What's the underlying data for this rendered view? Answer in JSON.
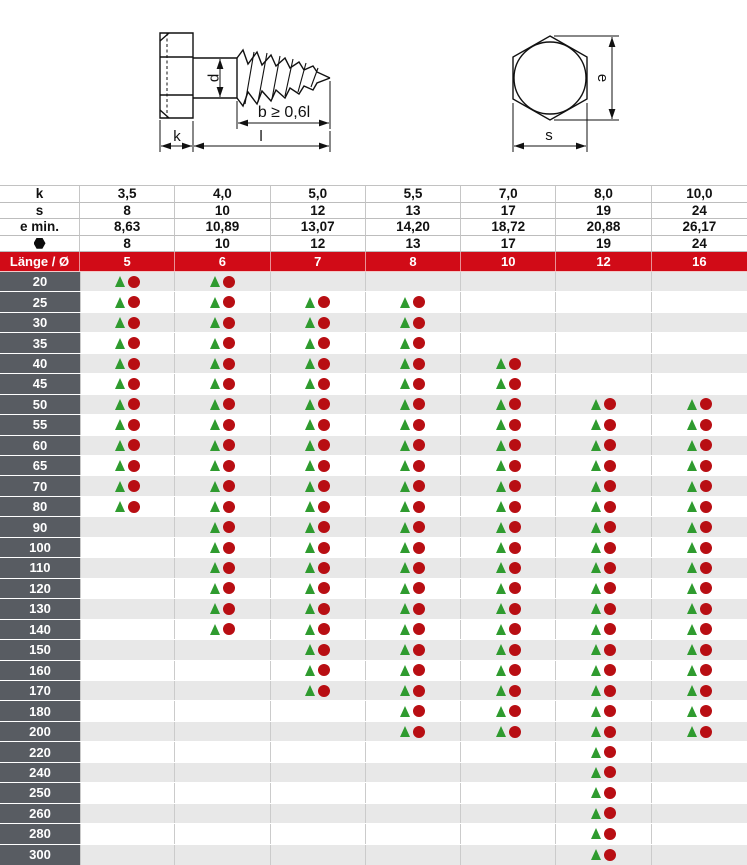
{
  "drawing": {
    "shank_diameter_label": "d",
    "thread_length_label": "b ≥ 0,6l",
    "head_height_label": "k",
    "total_length_label": "l",
    "across_corners_label": "e",
    "across_flats_label": "s"
  },
  "spec_header": {
    "rows": [
      {
        "name": "head-height",
        "label": "k",
        "icon": null,
        "values": [
          "3,5",
          "4,0",
          "5,0",
          "5,5",
          "7,0",
          "8,0",
          "10,0"
        ]
      },
      {
        "name": "across-flats",
        "label": "s",
        "icon": null,
        "values": [
          "8",
          "10",
          "12",
          "13",
          "17",
          "19",
          "24"
        ]
      },
      {
        "name": "across-corners-min",
        "label": "e min.",
        "icon": null,
        "values": [
          "8,63",
          "10,89",
          "13,07",
          "14,20",
          "18,72",
          "20,88",
          "26,17"
        ]
      },
      {
        "name": "wrench-size",
        "label": "",
        "icon": "hex-nut-icon",
        "values": [
          "8",
          "10",
          "12",
          "13",
          "17",
          "19",
          "24"
        ]
      }
    ]
  },
  "diameter_header": {
    "label": "Länge / Ø",
    "values": [
      "5",
      "6",
      "7",
      "8",
      "10",
      "12",
      "16"
    ]
  },
  "availability": {
    "marker_pair": [
      "green-triangle-marker",
      "red-circle-marker"
    ],
    "rows": [
      {
        "length": "20",
        "cells": [
          1,
          1,
          0,
          0,
          0,
          0,
          0
        ]
      },
      {
        "length": "25",
        "cells": [
          1,
          1,
          1,
          1,
          0,
          0,
          0
        ]
      },
      {
        "length": "30",
        "cells": [
          1,
          1,
          1,
          1,
          0,
          0,
          0
        ]
      },
      {
        "length": "35",
        "cells": [
          1,
          1,
          1,
          1,
          0,
          0,
          0
        ]
      },
      {
        "length": "40",
        "cells": [
          1,
          1,
          1,
          1,
          1,
          0,
          0
        ]
      },
      {
        "length": "45",
        "cells": [
          1,
          1,
          1,
          1,
          1,
          0,
          0
        ]
      },
      {
        "length": "50",
        "cells": [
          1,
          1,
          1,
          1,
          1,
          1,
          1
        ]
      },
      {
        "length": "55",
        "cells": [
          1,
          1,
          1,
          1,
          1,
          1,
          1
        ]
      },
      {
        "length": "60",
        "cells": [
          1,
          1,
          1,
          1,
          1,
          1,
          1
        ]
      },
      {
        "length": "65",
        "cells": [
          1,
          1,
          1,
          1,
          1,
          1,
          1
        ]
      },
      {
        "length": "70",
        "cells": [
          1,
          1,
          1,
          1,
          1,
          1,
          1
        ]
      },
      {
        "length": "80",
        "cells": [
          1,
          1,
          1,
          1,
          1,
          1,
          1
        ]
      },
      {
        "length": "90",
        "cells": [
          0,
          1,
          1,
          1,
          1,
          1,
          1
        ]
      },
      {
        "length": "100",
        "cells": [
          0,
          1,
          1,
          1,
          1,
          1,
          1
        ]
      },
      {
        "length": "110",
        "cells": [
          0,
          1,
          1,
          1,
          1,
          1,
          1
        ]
      },
      {
        "length": "120",
        "cells": [
          0,
          1,
          1,
          1,
          1,
          1,
          1
        ]
      },
      {
        "length": "130",
        "cells": [
          0,
          1,
          1,
          1,
          1,
          1,
          1
        ]
      },
      {
        "length": "140",
        "cells": [
          0,
          1,
          1,
          1,
          1,
          1,
          1
        ]
      },
      {
        "length": "150",
        "cells": [
          0,
          0,
          1,
          1,
          1,
          1,
          1
        ]
      },
      {
        "length": "160",
        "cells": [
          0,
          0,
          1,
          1,
          1,
          1,
          1
        ]
      },
      {
        "length": "170",
        "cells": [
          0,
          0,
          1,
          1,
          1,
          1,
          1
        ]
      },
      {
        "length": "180",
        "cells": [
          0,
          0,
          0,
          1,
          1,
          1,
          1
        ]
      },
      {
        "length": "200",
        "cells": [
          0,
          0,
          0,
          1,
          1,
          1,
          1
        ]
      },
      {
        "length": "220",
        "cells": [
          0,
          0,
          0,
          0,
          0,
          1,
          0
        ]
      },
      {
        "length": "240",
        "cells": [
          0,
          0,
          0,
          0,
          0,
          1,
          0
        ]
      },
      {
        "length": "250",
        "cells": [
          0,
          0,
          0,
          0,
          0,
          1,
          0
        ]
      },
      {
        "length": "260",
        "cells": [
          0,
          0,
          0,
          0,
          0,
          1,
          0
        ]
      },
      {
        "length": "280",
        "cells": [
          0,
          0,
          0,
          0,
          0,
          1,
          0
        ]
      },
      {
        "length": "300",
        "cells": [
          0,
          0,
          0,
          0,
          0,
          1,
          0
        ]
      }
    ]
  },
  "colors": {
    "header_red": "#d10b17",
    "label_gray": "#585c62",
    "row_alt": "#e8e8e8",
    "triangle_green": "#2f9b2f",
    "circle_red": "#b80e13"
  }
}
